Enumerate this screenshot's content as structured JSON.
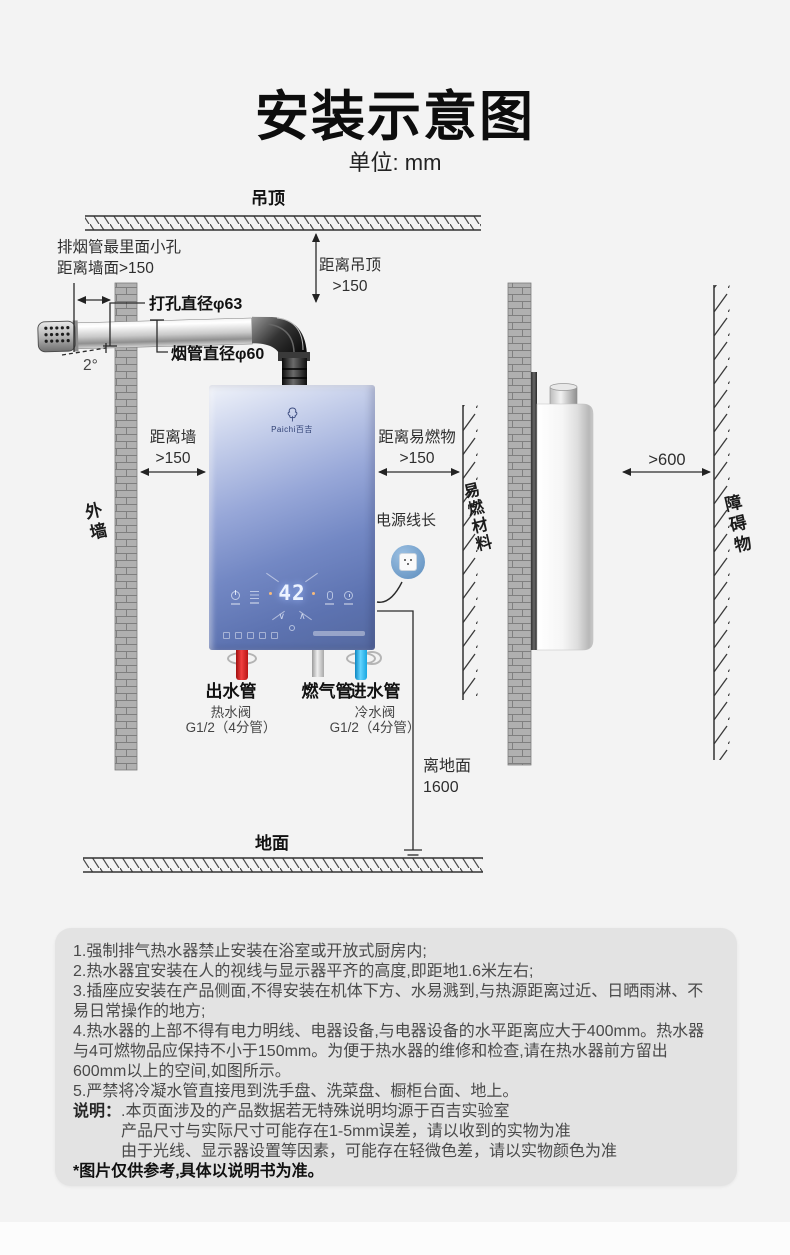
{
  "page": {
    "title": "安装示意图",
    "unit": "单位: mm"
  },
  "diagram": {
    "ceiling": "吊顶",
    "ground": "地面",
    "outer_wall": "外墙",
    "flammable_material": "易燃材料",
    "obstacle": "障碍物",
    "vent_note_line1": "排烟管最里面小孔",
    "vent_note_line2": "距离墙面>150",
    "hole_diameter": "打孔直径φ63",
    "flue_diameter": "烟管直径φ60",
    "tilt_angle": "2°",
    "dist_ceiling_label": "距离吊顶",
    "dist_ceiling_value": ">150",
    "dist_wall_label": "距离墙",
    "dist_wall_value": ">150",
    "dist_flammable_label": "距离易燃物",
    "dist_flammable_value": ">150",
    "dist_obstacle_value": ">600",
    "power_cord": "电源线长",
    "outlet_pipe": "出水管",
    "gas_pipe": "燃气管",
    "inlet_pipe": "进水管",
    "hot_valve": "热水阀",
    "hot_valve_spec": "G1/2（4分管）",
    "cold_valve": "冷水阀",
    "cold_valve_spec": "G1/2（4分管）",
    "height_label": "离地面",
    "height_value": "1600",
    "heater": {
      "brand": "Paichi百吉",
      "display_temp": "42"
    }
  },
  "notes": {
    "items": [
      "1.强制排气热水器禁止安装在浴室或开放式厨房内;",
      "2.热水器宜安装在人的视线与显示器平齐的高度,即距地1.6米左右;",
      "3.插座应安装在产品侧面,不得安装在机体下方、水易溅到,与热源距离过近、日晒雨淋、不易日常操作的地方;",
      "4.热水器的上部不得有电力明线、电器设备,与电器设备的水平距离应大于400mm。热水器与4可燃物品应保持不小于150mm。为便于热水器的维修和检查,请在热水器前方留出600mm以上的空间,如图所示。",
      "5.严禁将冷凝水管直接甩到洗手盘、洗菜盘、橱柜台面、地上。"
    ],
    "remark_label": "说明：",
    "remark_lines": [
      ".本页面涉及的产品数据若无特殊说明均源于百吉实验室",
      "产品尺寸与实际尺寸可能存在1-5mm误差，请以收到的实物为准",
      "由于光线、显示器设置等因素，可能存在轻微色差，请以实物颜色为准"
    ],
    "footnote": "*图片仅供参考,具体以说明书为准。"
  },
  "colors": {
    "page_bg": "#f3f3f3",
    "notes_bg": "#e3e3e3",
    "heater_blue": "#5b74b6",
    "hot_pipe_red": "#e02222",
    "cold_pipe_blue": "#38b6f0",
    "gas_pipe_gray": "#c8c8c8",
    "socket_blue": "#7aa6cf",
    "line_color": "#2b2b2b"
  }
}
